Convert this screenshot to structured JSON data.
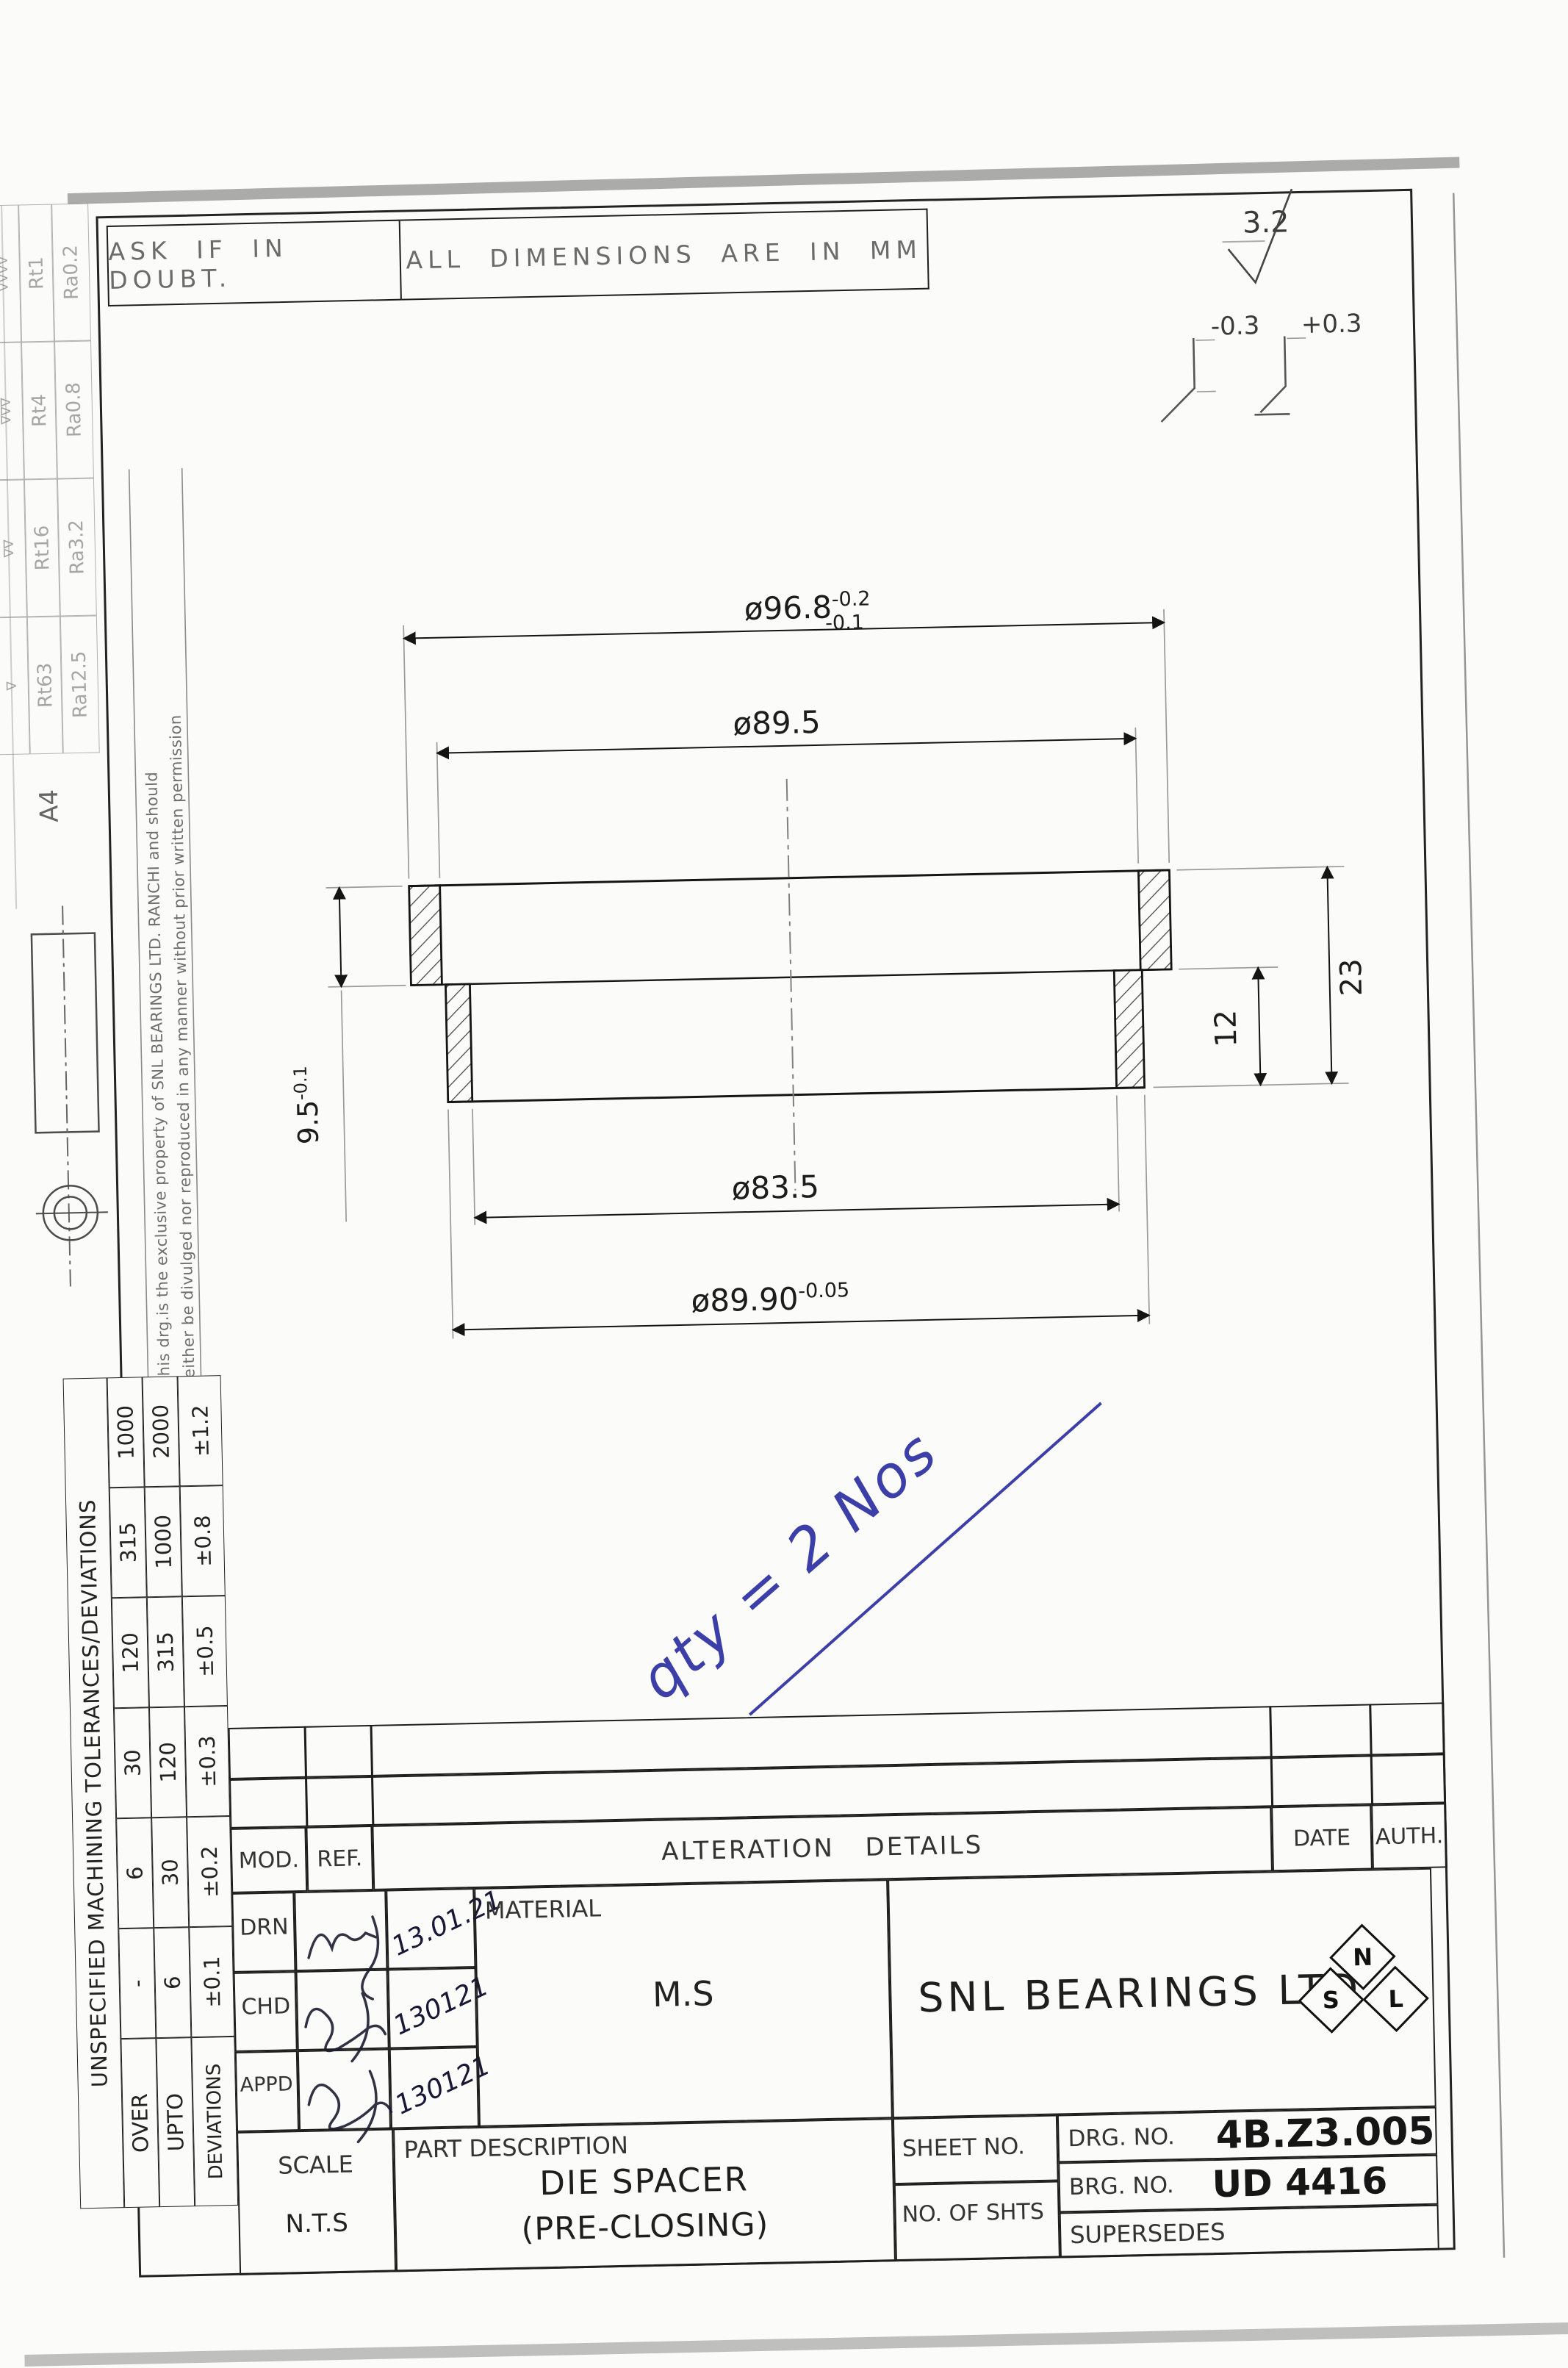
{
  "header": {
    "ask_note": "ASK IF IN DOUBT.",
    "units_note": "ALL DIMENSIONS ARE IN MM"
  },
  "top_symbols": {
    "surface_finish": "3.2",
    "edge_break_minus": "-0.3",
    "edge_break_plus": "+0.3"
  },
  "margin": {
    "sheet_size": "A4",
    "finish_table": {
      "marks": [
        "∇∇∇∇",
        "∇∇∇",
        "∇∇",
        "∇"
      ],
      "rt": [
        "Rt1",
        "Rt4",
        "Rt16",
        "Rt63"
      ],
      "ra": [
        "Ra0.2",
        "Ra0.8",
        "Ra3.2",
        "Ra12.5"
      ]
    },
    "property_note_line1": "This drg.is the exclusive property of SNL BEARINGS LTD. RANCHI and should",
    "property_note_line2": "neither be divulged nor reproduced in any manner without prior written permission"
  },
  "tolerance_table": {
    "title": "UNSPECIFIED MACHINING TOLERANCES/DEVIATIONS",
    "over_label": "OVER",
    "upto_label": "UPTO",
    "deviations_label": "DEVIATIONS",
    "over": [
      "-",
      "6",
      "30",
      "120",
      "315",
      "1000"
    ],
    "upto": [
      "6",
      "30",
      "120",
      "315",
      "1000",
      "2000"
    ],
    "deviations": [
      "±0.1",
      "±0.2",
      "±0.3",
      "±0.5",
      "±0.8",
      "±1.2"
    ]
  },
  "drawing": {
    "dims": {
      "outer_dia": {
        "main": "ø96.8",
        "sup": "-0.2",
        "sub": "-0.1"
      },
      "flange_bore": "ø89.5",
      "bore": "ø83.5",
      "lower_dia": {
        "main": "ø89.90",
        "sup": "-0.05"
      },
      "flange_height": {
        "main": "9.5",
        "sup": "-0.1"
      },
      "lower_height": "12",
      "total_height": "23"
    },
    "qty_note": "qty = 2 Nos"
  },
  "title_block": {
    "mod_label": "MOD.",
    "ref_label": "REF.",
    "alteration_label": "ALTERATION  DETAILS",
    "date_label": "DATE",
    "auth_label": "AUTH.",
    "personnel": [
      {
        "role": "DRN",
        "date": "13.01.21"
      },
      {
        "role": "CHD",
        "date": "130121"
      },
      {
        "role": "APPD",
        "date": "130121"
      }
    ],
    "material_label": "MATERIAL",
    "material_value": "M.S",
    "company_name": "SNL BEARINGS LTD.",
    "logo_letters": {
      "s": "S",
      "n": "N",
      "l": "L"
    },
    "scale_label": "SCALE",
    "scale_value": "N.T.S",
    "part_description_label": "PART DESCRIPTION",
    "part_name": "DIE SPACER",
    "part_variant": "(PRE-CLOSING)",
    "sheet_no_label": "SHEET NO.",
    "no_of_shts_label": "NO. OF SHTS",
    "drg_no_label": "DRG. NO.",
    "drg_no_value": "4B.Z3.005",
    "brg_no_label": "BRG. NO.",
    "brg_no_value": "UD 4416",
    "supersedes_label": "SUPERSEDES"
  }
}
